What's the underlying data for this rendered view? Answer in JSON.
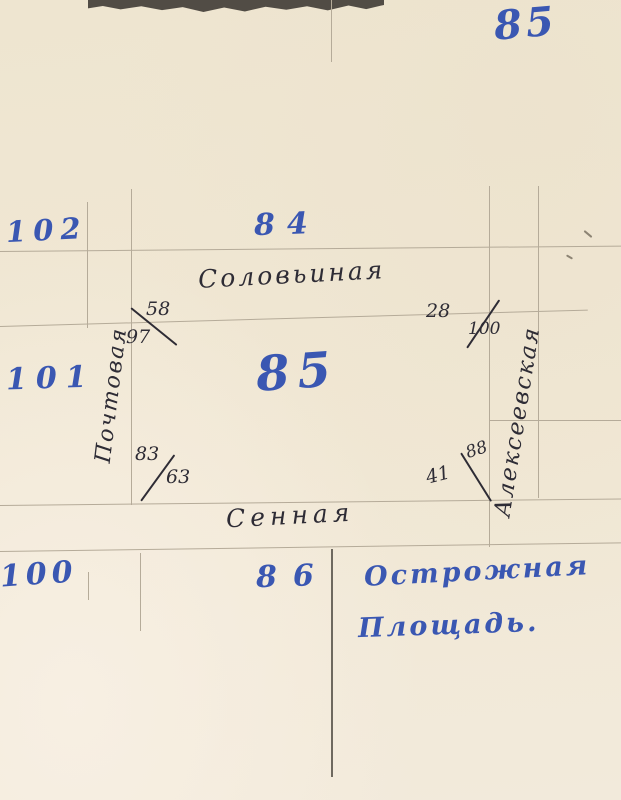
{
  "document": {
    "kind": "handwritten block plan, scanned notebook page",
    "page_number": "85"
  },
  "colors": {
    "paper": "#f1e8d5",
    "blue_ink": "#3a57b2",
    "black_ink": "#2e2c35",
    "pencil_line": "#b5ab99",
    "dark_pencil_line": "#6e695f",
    "torn_edge": "#514c45"
  },
  "block_numbers": {
    "left_upper": "102",
    "left_middle": "101",
    "left_lower": "100",
    "top": "84",
    "center": "85",
    "bottom": "86"
  },
  "street_names": {
    "top": "Соловьиная",
    "bottom": "Сенная",
    "left_vertical": "Почтовая",
    "right_vertical": "Алексеевская"
  },
  "square_label": {
    "line1": "Острожная",
    "line2": "Площадь."
  },
  "corner_house_numbers": {
    "top_left": {
      "upper": "58",
      "lower": "97"
    },
    "top_right": {
      "left": "28",
      "right": "100"
    },
    "bottom_left": {
      "upper": "83",
      "lower": "63"
    },
    "bottom_right": {
      "upper": "88",
      "lower": "41"
    }
  }
}
